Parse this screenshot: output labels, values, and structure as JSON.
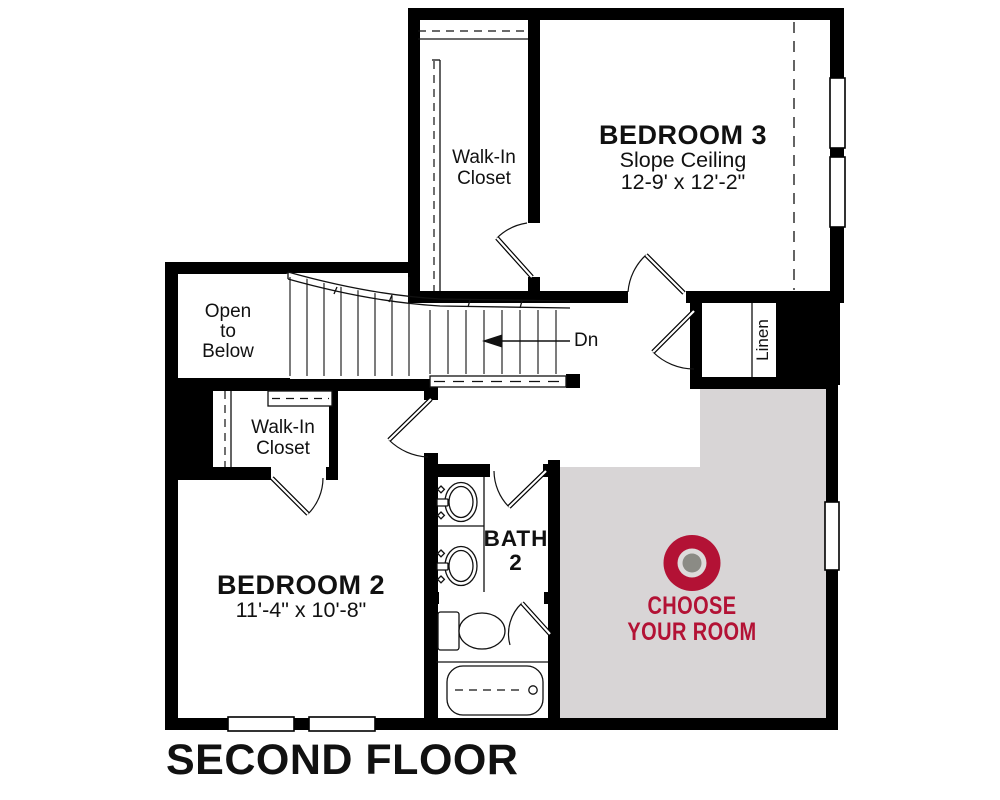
{
  "floor_title": "SECOND FLOOR",
  "colors": {
    "wall": "#000000",
    "accent": "#b31235",
    "room_fill": "#d8d5d6",
    "target_center": "#8b8b85",
    "target_inner": "#dddbdb"
  },
  "rooms": {
    "bedroom3": {
      "name": "BEDROOM 3",
      "ceiling_note": "Slope Ceiling",
      "dimensions": "12-9' x 12'-2\""
    },
    "walk_in_closet_top": {
      "line1": "Walk-In",
      "line2": "Closet"
    },
    "open_to_below": {
      "line1": "Open",
      "line2": "to",
      "line3": "Below"
    },
    "stairs": {
      "down_label": "Dn"
    },
    "linen_closet": {
      "name": "Linen"
    },
    "walk_in_closet_left": {
      "line1": "Walk-In",
      "line2": "Closet"
    },
    "bedroom2": {
      "name": "BEDROOM 2",
      "dimensions": "11'-4\" x 10'-8\""
    },
    "bath2": {
      "line1": "BATH",
      "line2": "2"
    },
    "choose_room": {
      "line1": "CHOOSE",
      "line2": "YOUR ROOM",
      "icon": "bullseye-target-icon"
    }
  }
}
